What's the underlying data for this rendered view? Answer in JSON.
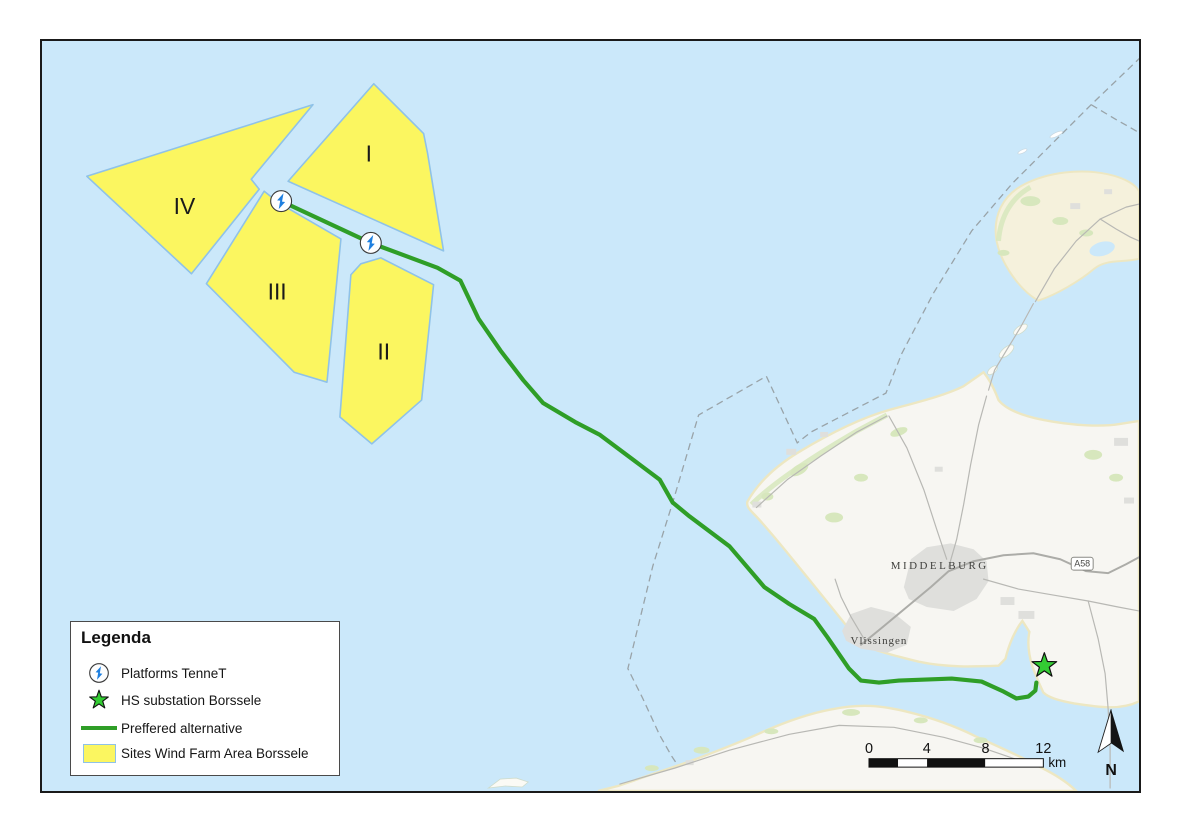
{
  "map": {
    "labels": {
      "middelburg": "MIDDELBURG",
      "vlissingen": "Vlissingen",
      "road_badge": "A58",
      "north": "N"
    },
    "wind_farm_areas": [
      {
        "label": "I"
      },
      {
        "label": "II"
      },
      {
        "label": "III"
      },
      {
        "label": "IV"
      }
    ],
    "scale_bar": {
      "ticks": [
        "0",
        "4",
        "8",
        "12"
      ],
      "unit": "km"
    }
  },
  "legend": {
    "title": "Legenda",
    "items": [
      {
        "icon": "platform-icon",
        "label": "Platforms TenneT"
      },
      {
        "icon": "star-icon",
        "label": "HS substation Borssele"
      },
      {
        "icon": "route-line",
        "label": "Preffered alternative"
      },
      {
        "icon": "area-swatch",
        "label": "Sites Wind Farm Area Borssele"
      }
    ]
  },
  "colors": {
    "sea": "#CBE8FA",
    "land": "#F7F6F2",
    "island-sand": "#F5F1DC",
    "coast-sand": "#EDE7C2",
    "vegetation": "#D7E7BD",
    "urban": "#DFDFDC",
    "road": "#B8B8B4",
    "wind-farm-fill": "#FBF660",
    "wind-farm-stroke": "#8FC2E8",
    "route-green": "#2F9E27",
    "bolt-blue": "#1D7FE0",
    "star-green": "#33CC33",
    "boundary-dash": "#99A3A8",
    "frame": "#1A1A1A",
    "text-dark": "#1A1A1A"
  }
}
